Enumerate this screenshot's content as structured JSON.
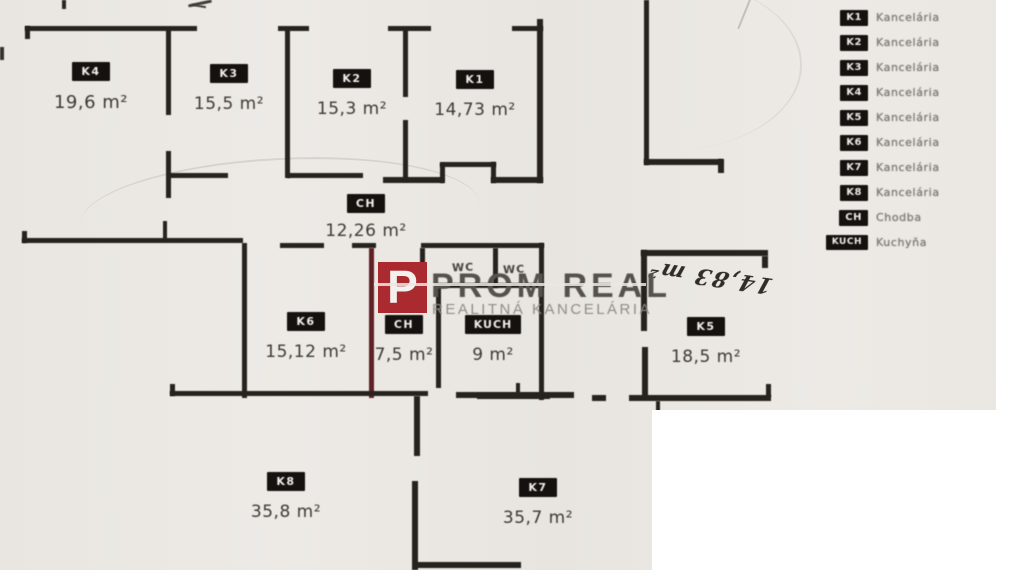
{
  "plan": {
    "rooms": [
      {
        "code": "K4",
        "area": "19,6 m²"
      },
      {
        "code": "K3",
        "area": "15,5 m²"
      },
      {
        "code": "K2",
        "area": "15,3 m²"
      },
      {
        "code": "K1",
        "area": "14,73 m²"
      },
      {
        "code": "CH",
        "area": "12,26 m²"
      },
      {
        "code": "K6",
        "area": "15,12 m²"
      },
      {
        "code": "CH",
        "area": "7,5 m²"
      },
      {
        "code": "KUCH",
        "area": "9 m²"
      },
      {
        "code": "K5",
        "area": "18,5 m²"
      },
      {
        "code": "K8",
        "area": "35,8 m²"
      },
      {
        "code": "K7",
        "area": "35,7 m²"
      }
    ],
    "wc_labels": [
      "WC",
      "WC"
    ],
    "handwritten_note": "14,83 m²"
  },
  "watermark": {
    "logo_letter": "P",
    "brand": "PROM REAL",
    "tagline": "REALITNÁ KANCELÁRIA",
    "accent_color": "#ab2a30"
  },
  "legend": {
    "items": [
      {
        "code": "K1",
        "label": "Kancelária"
      },
      {
        "code": "K2",
        "label": "Kancelária"
      },
      {
        "code": "K3",
        "label": "Kancelária"
      },
      {
        "code": "K4",
        "label": "Kancelária"
      },
      {
        "code": "K5",
        "label": "Kancelária"
      },
      {
        "code": "K6",
        "label": "Kancelária"
      },
      {
        "code": "K7",
        "label": "Kancelária"
      },
      {
        "code": "K8",
        "label": "Kancelária"
      },
      {
        "code": "CH",
        "label": "Chodba"
      },
      {
        "code": "KUCH",
        "label": "Kuchyňa"
      }
    ]
  },
  "colors": {
    "background": "#eae7e2",
    "wall": "#26221e",
    "badge": "#14110e",
    "accent_red": "#ab2a30",
    "patch_white": "#ffffff"
  }
}
